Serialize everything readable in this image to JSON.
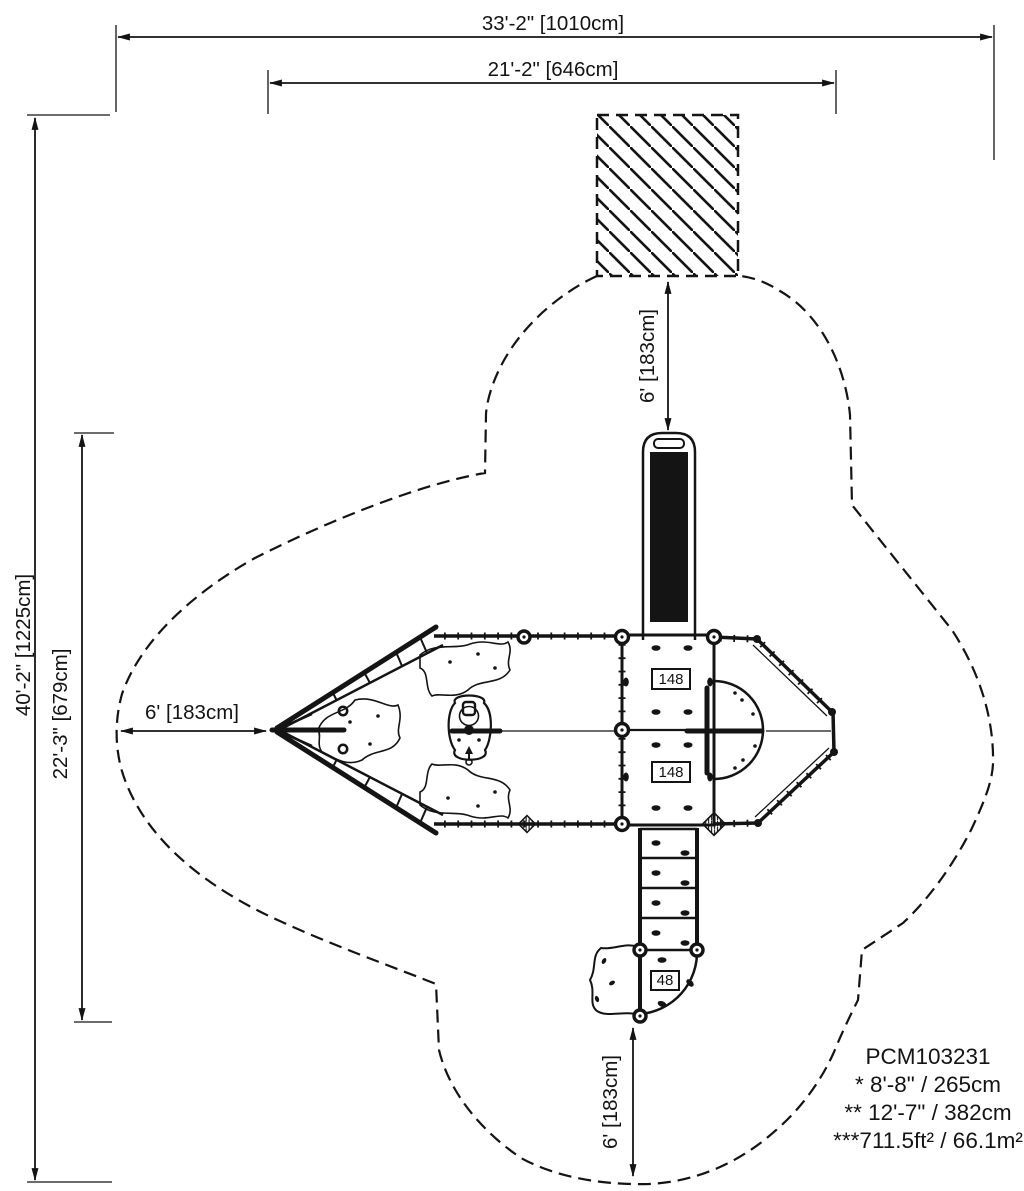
{
  "drawing": {
    "background_color": "#ffffff",
    "line_color": "#141414",
    "model_number": "PCM103231",
    "notes": {
      "line1": "* 8'-8\" / 265cm",
      "line2": "** 12'-7\" / 382cm",
      "line3": "***711.5ft² / 66.1m²"
    },
    "dimensions": {
      "overall_width": "33'-2\" [1010cm]",
      "structure_width": "21'-2\" [646cm]",
      "overall_depth": "40'-2\" [1225cm]",
      "structure_depth": "22'-3\" [679cm]",
      "exit_zone_top": "6' [183cm]",
      "exit_zone_left": "6' [183cm]",
      "exit_zone_bottom": "6' [183cm]"
    },
    "deck_labels": {
      "upper_deck": "148",
      "lower_deck": "148",
      "bottom_deck": "48"
    }
  }
}
